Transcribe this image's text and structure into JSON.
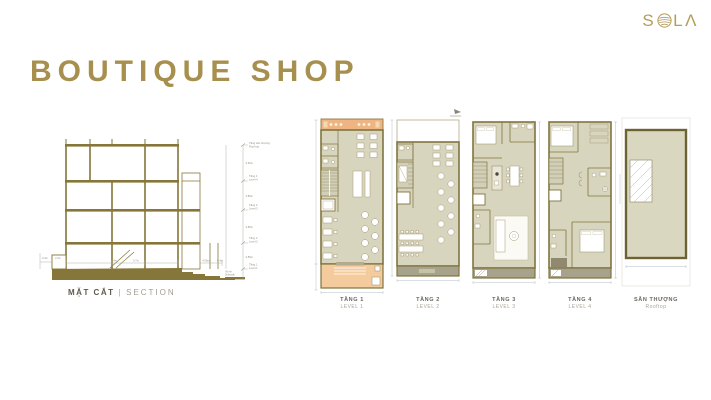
{
  "brand": {
    "name": "SOLA",
    "letter_s": "S",
    "letter_l": "L",
    "letter_a": "Λ",
    "o_icon": "spiral-shell-o-icon",
    "color": "#b59c58"
  },
  "title": {
    "text": "BOUTIQUE SHOP",
    "color": "#a7904e"
  },
  "section": {
    "caption": {
      "vi": "MẶT CẮT",
      "sep": "|",
      "en": "SECTION"
    },
    "levels": [
      {
        "vi": "Tầng sân thượng",
        "en": "Roof top"
      },
      {
        "vi": "Tầng 4",
        "en": "Level 4"
      },
      {
        "vi": "Tầng 3",
        "en": "Level 3"
      },
      {
        "vi": "Tầng 2",
        "en": "Level 2"
      },
      {
        "vi": "Tầng 1",
        "en": "Level 1"
      }
    ],
    "floor_heights": [
      "3.60m",
      "3.80m",
      "3.80m",
      "3.85m"
    ],
    "ground": {
      "vi": "Vỉa hè",
      "en": "Sidewalk"
    },
    "bottom_dims": [
      "0.4m",
      "2.4m",
      "5.4m",
      "0.7m",
      "4.05m",
      "0.4m"
    ]
  },
  "plans": [
    {
      "vi": "TẦNG 1",
      "en": "LEVEL 1",
      "type": "shop-restaurant-plan"
    },
    {
      "vi": "TẦNG 2",
      "en": "LEVEL 2",
      "type": "restaurant-plan"
    },
    {
      "vi": "TẦNG 3",
      "en": "LEVEL 3",
      "type": "apartment-plan"
    },
    {
      "vi": "TẦNG 4",
      "en": "LEVEL 4",
      "type": "apartment-plan"
    },
    {
      "vi": "SÂN THƯỢNG",
      "en": "Rooftop",
      "type": "roof-terrace-plan"
    }
  ],
  "colors": {
    "gold": "#a7904e",
    "olive_line": "#80743e",
    "olive_solid": "#867639",
    "plan_floor": "#d8d5bf",
    "awning_orange": "#eeb583",
    "entry_orange": "#f4cb9d",
    "balcony_gray": "#a6a28c",
    "dim_line": "#a4b0ba",
    "annotation_text": "#97917f"
  }
}
